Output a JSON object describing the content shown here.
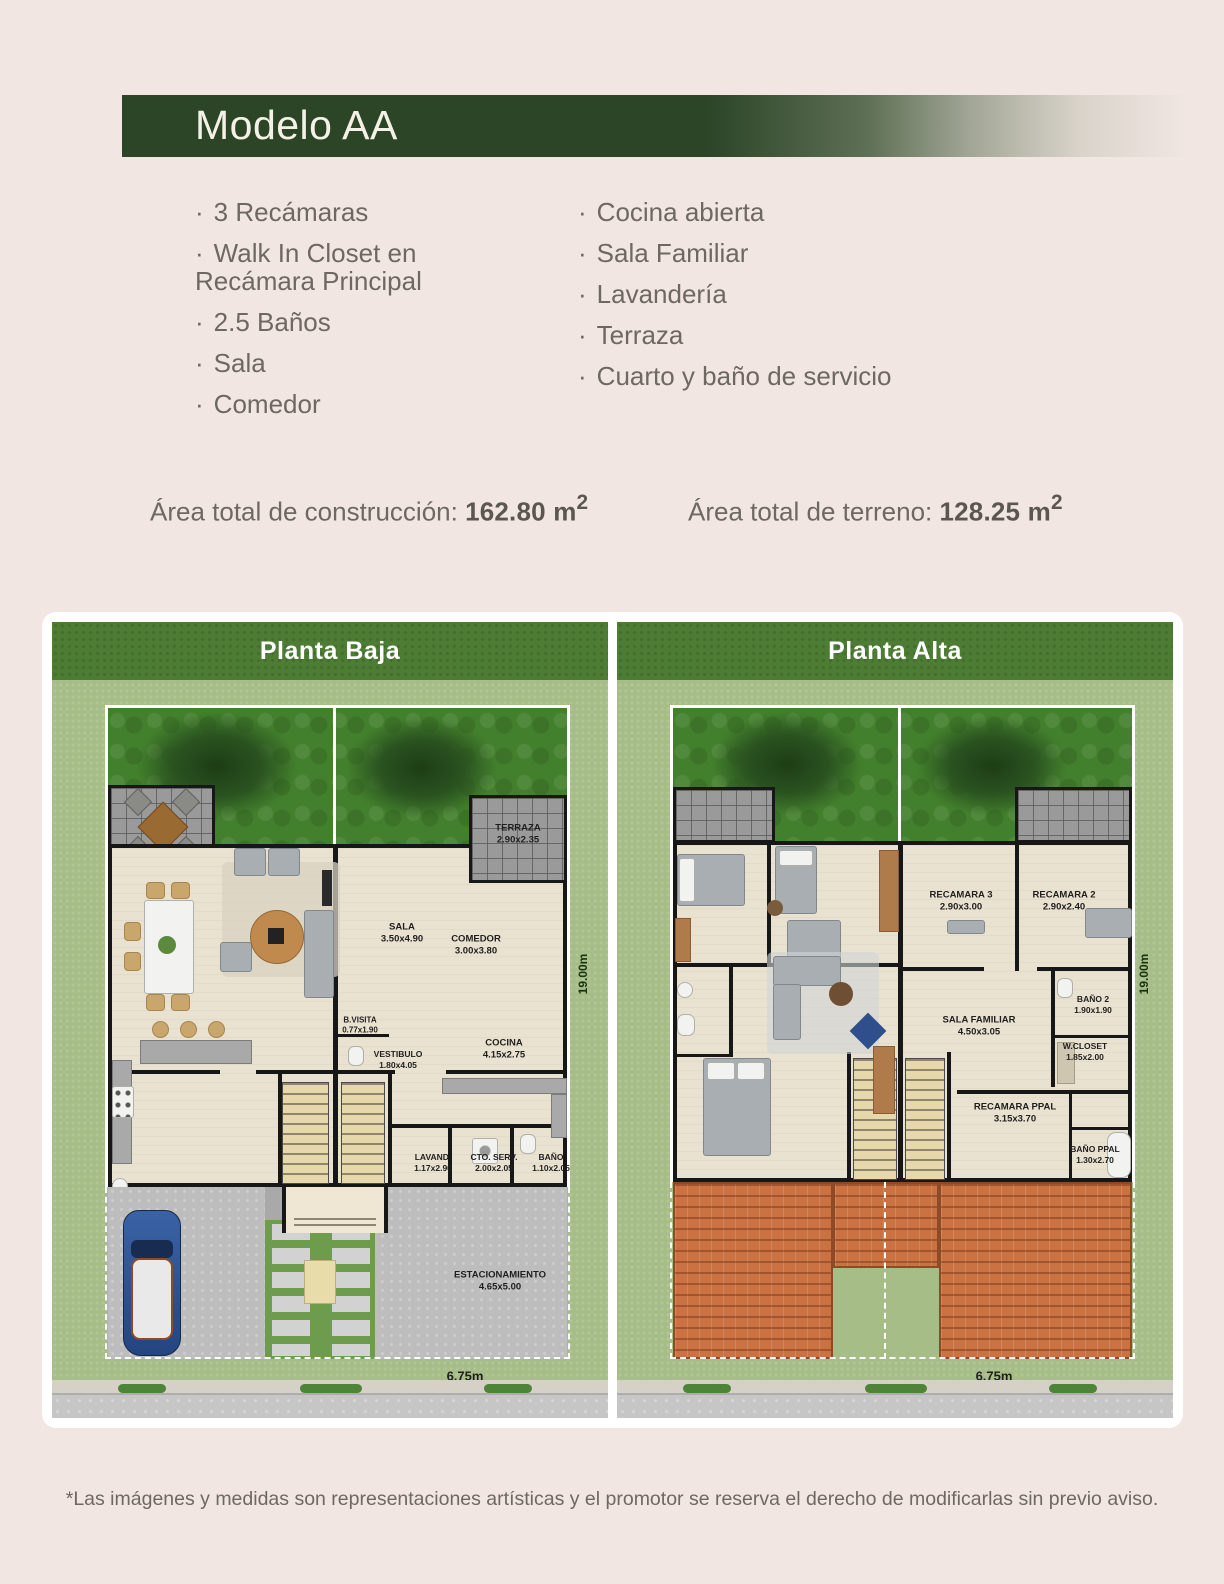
{
  "header": {
    "title": "Modelo AA"
  },
  "features": {
    "left": [
      "3 Recámaras",
      "Walk In Closet en\n Recámara Principal",
      "2.5 Baños",
      "Sala",
      "Comedor"
    ],
    "right": [
      "Cocina abierta",
      "Sala Familiar",
      "Lavandería",
      "Terraza",
      "Cuarto y baño de servicio"
    ]
  },
  "areas": {
    "construction_label": "Área total de construcción: ",
    "construction_value": "162.80 m",
    "terrain_label": "Área total de terreno: ",
    "terrain_value": "128.25 m",
    "sup": "2"
  },
  "plans": {
    "baja": {
      "title": "Planta Baja",
      "rooms": [
        {
          "name": "TERRAZA",
          "dims": "2.90x2.35"
        },
        {
          "name": "SALA",
          "dims": "3.50x4.90"
        },
        {
          "name": "COMEDOR",
          "dims": "3.00x3.80"
        },
        {
          "name": "COCINA",
          "dims": "4.15x2.75"
        },
        {
          "name": "B.VISITA",
          "dims": "0.77x1.90"
        },
        {
          "name": "VESTIBULO",
          "dims": "1.80x4.05"
        },
        {
          "name": "LAVAND.",
          "dims": "1.17x2.90"
        },
        {
          "name": "CTO. SERV.",
          "dims": "2.00x2.05"
        },
        {
          "name": "BAÑO",
          "dims": "1.10x2.05"
        },
        {
          "name": "ESTACIONAMIENTO",
          "dims": "4.65x5.00"
        }
      ],
      "width_dim": "6.75m",
      "height_dim": "19.00m"
    },
    "alta": {
      "title": "Planta Alta",
      "rooms": [
        {
          "name": "RECAMARA 3",
          "dims": "2.90x3.00"
        },
        {
          "name": "RECAMARA 2",
          "dims": "2.90x2.40"
        },
        {
          "name": "BAÑO 2",
          "dims": "1.90x1.90"
        },
        {
          "name": "SALA FAMILIAR",
          "dims": "4.50x3.05"
        },
        {
          "name": "W.CLOSET",
          "dims": "1.85x2.00"
        },
        {
          "name": "RECAMARA PPAL",
          "dims": "3.15x3.70"
        },
        {
          "name": "BAÑO PPAL",
          "dims": "1.30x2.70"
        }
      ],
      "width_dim": "6.75m",
      "height_dim": "19.00m"
    }
  },
  "footer": {
    "disclaimer": "*Las imágenes y medidas son representaciones artísticas y el promotor se reserva el derecho de modificarlas sin previo aviso."
  },
  "colors": {
    "page_bg": "#f1e6e2",
    "header_green": "#2c4527",
    "plan_band_green": "#4d7c34",
    "lawn_green": "#43802d",
    "margin_green": "#a7bd88",
    "floor_beige": "#eae2d0",
    "wall_black": "#171717",
    "roof_orange": "#cb7243",
    "text_gray": "#6e6862"
  }
}
